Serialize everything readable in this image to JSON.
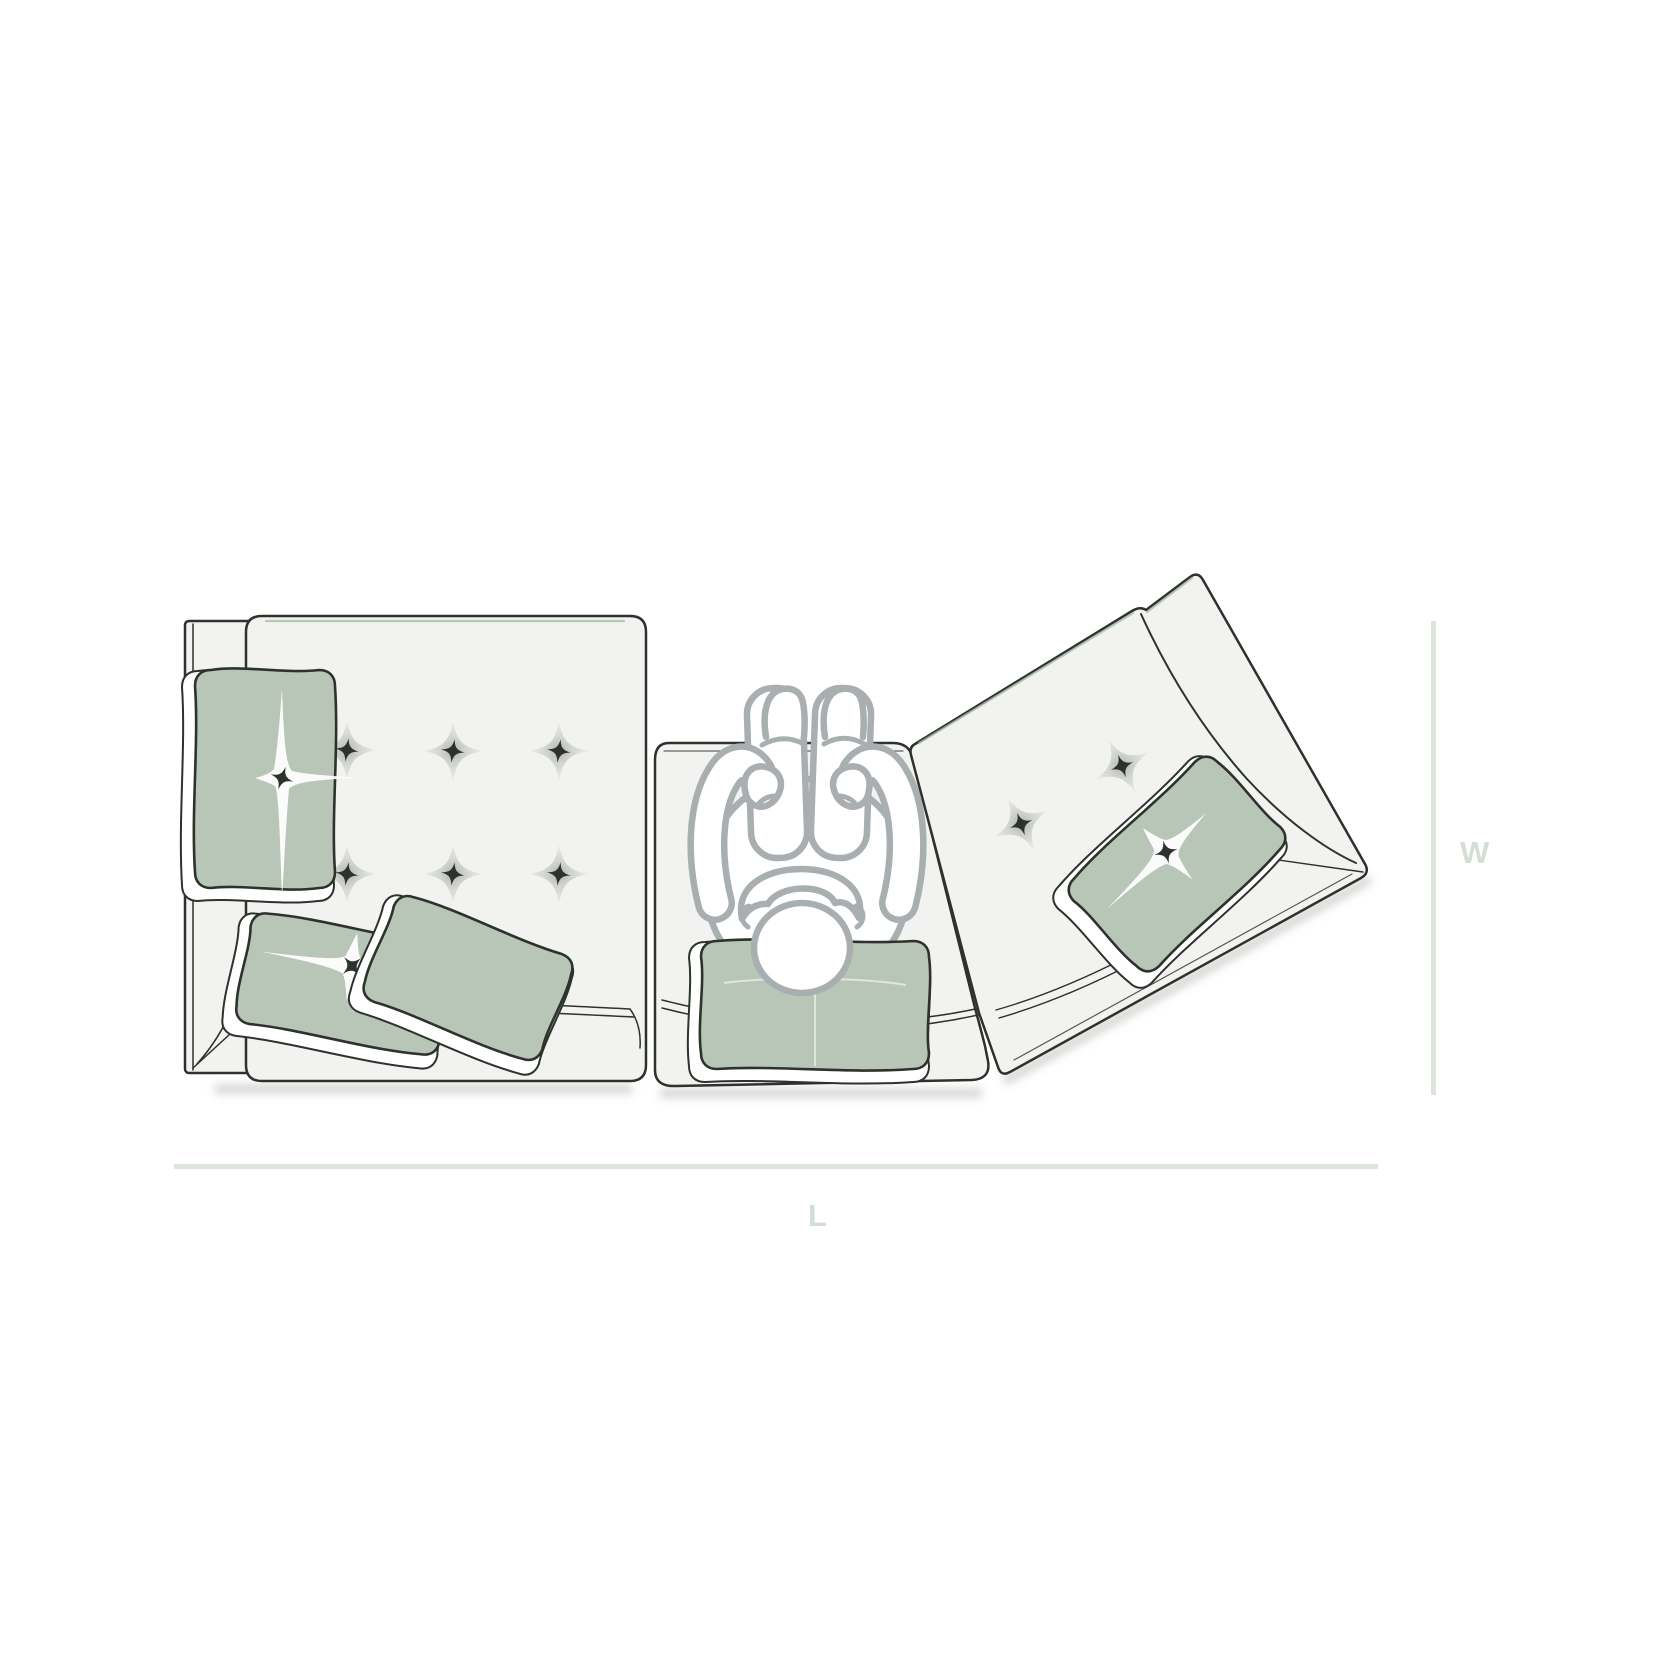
{
  "figure": {
    "dimension_width_label": "W",
    "dimension_length_label": "L"
  },
  "scene": {
    "description_counts": {
      "modules": 3,
      "left_module_tufts": 6,
      "right_module_tufts": 2,
      "pillows_total": 5,
      "person_figures": 1
    },
    "modules": [
      {
        "name": "left seat module",
        "tufts": 6,
        "pillows": 3
      },
      {
        "name": "center seat module",
        "pillows": 1,
        "occupied_by_person": true
      },
      {
        "name": "right seat module angled",
        "tufts": 2,
        "pillows": 1
      }
    ]
  },
  "colors": {
    "background": "#ffffff",
    "mat_fill": "#f2f3f1",
    "outline_dark": "#2d322d",
    "pillow_sage": "#b8c6b8",
    "crease_sage": "#9fb2a0",
    "person_gray": "#a9aeb0",
    "dimension_line": "#dce4dc",
    "dimension_label": "#d3ded4",
    "shadow": "#aeb2ac"
  }
}
